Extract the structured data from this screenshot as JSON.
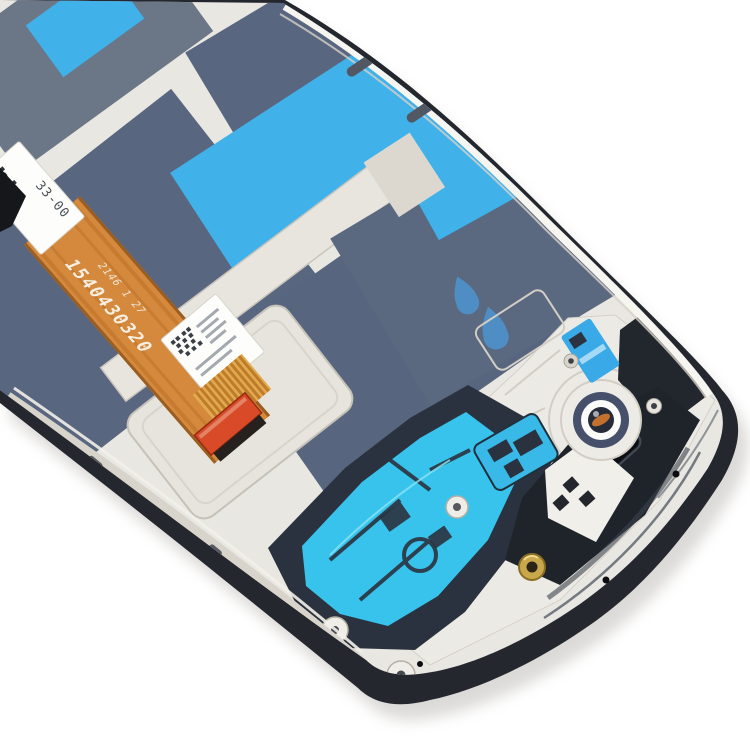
{
  "photo": {
    "subject": "smartphone-lcd-frame-assembly-rear-view",
    "background_color": "#ffffff",
    "labels": {
      "top_label_code": "33-00",
      "flex_part_number": "1540430320",
      "flex_batch_code": "2146 1 27"
    },
    "colors": {
      "frame_black": "#24272d",
      "metal_base": "#e9e7e2",
      "metal_bright": "#f7f5f0",
      "metal_plate": "#eceae4",
      "slate_sheet": "#59667f",
      "slate_light": "#6b7687",
      "slate_dark": "#57657e",
      "slate_mid": "#5a6880",
      "tape_cyan": "#41b1ea",
      "antenna_cyan": "#37c3ec",
      "navy_plastic": "#2b323f",
      "flex_orange": "#d5893d",
      "flex_stripe": "#b96f26",
      "connector_red": "#d94b28",
      "gold_screw": "#c9a84c",
      "camera_ring_navy": "#46506b",
      "camera_center_orange": "#c4702f",
      "teardrop_blue": "#4f8ec4",
      "tab_blue": "#3aa9e8",
      "label_white": "#fdfdfb"
    }
  }
}
